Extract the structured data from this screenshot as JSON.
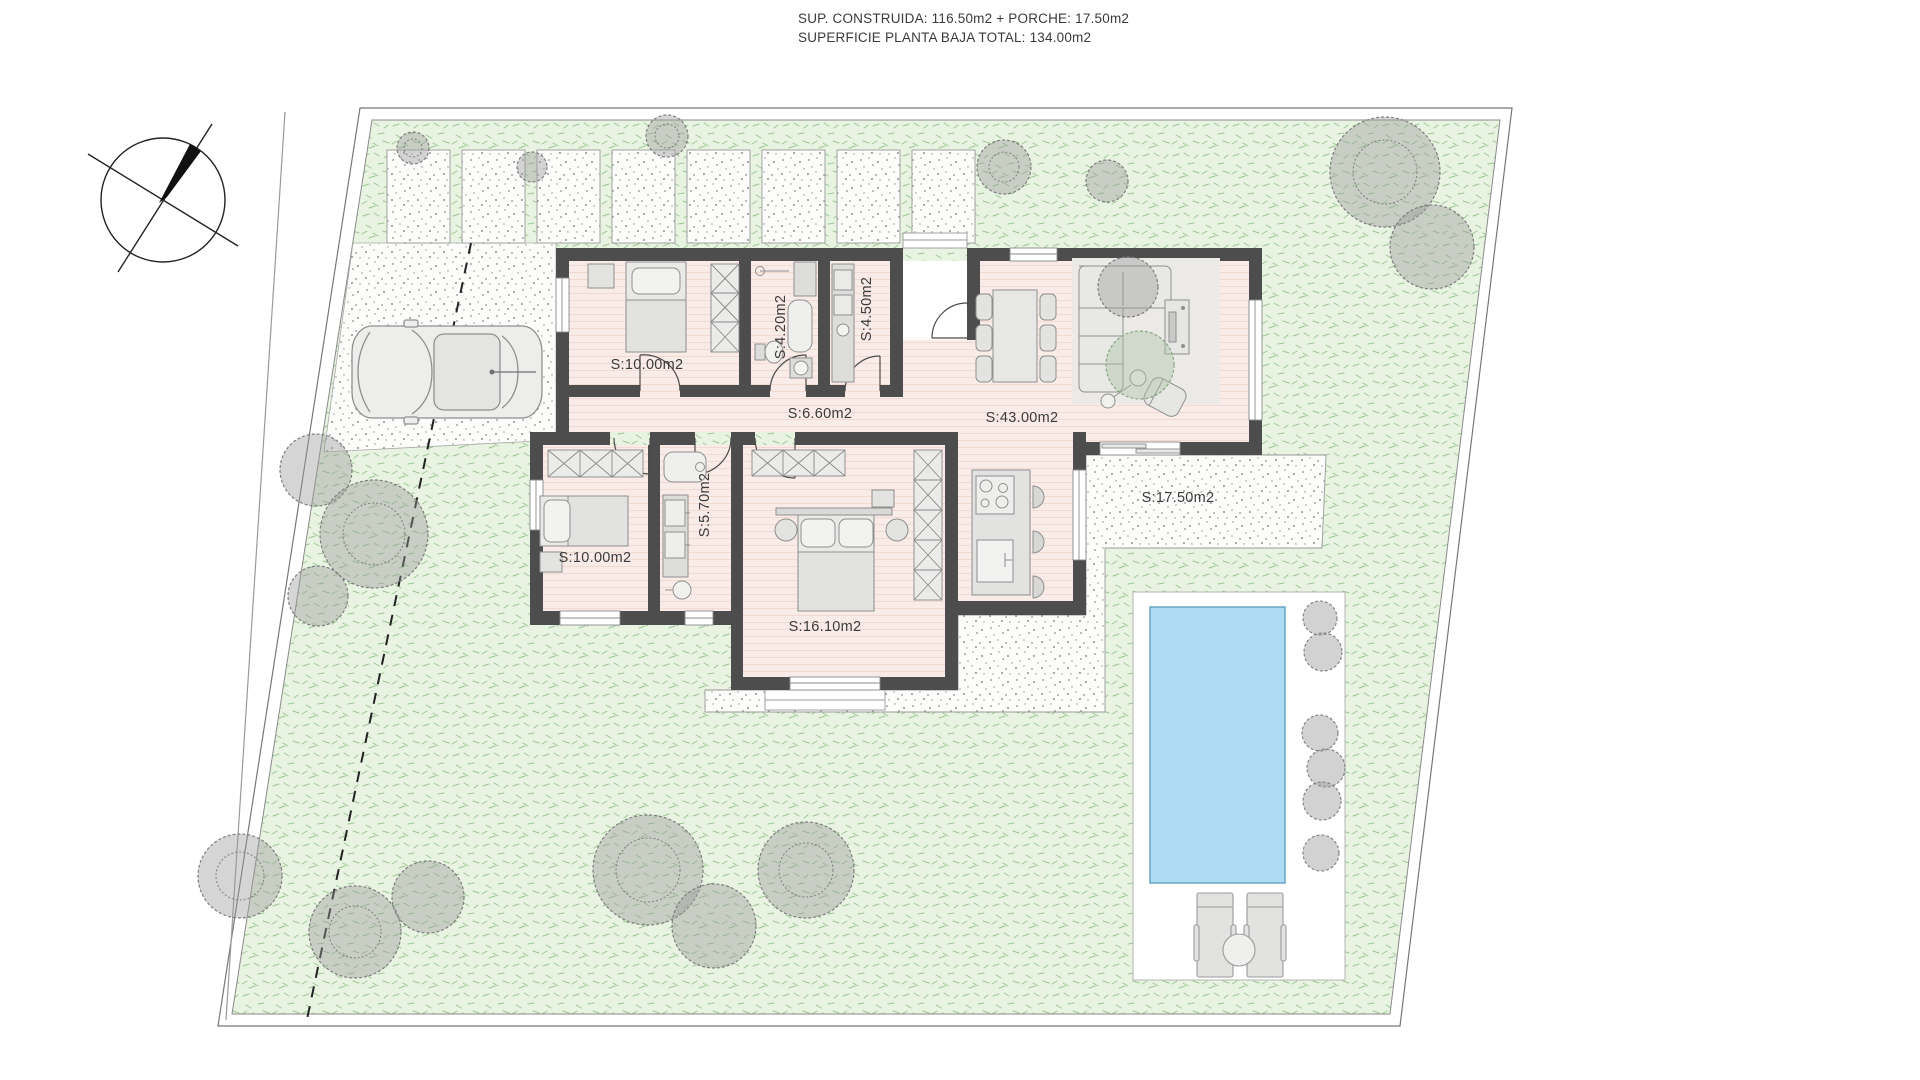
{
  "title": {
    "line1": "SUP. CONSTRUIDA: 116.50m2 + PORCHE: 17.50m2",
    "line2": "SUPERFICIE PLANTA BAJA TOTAL: 134.00m2"
  },
  "rooms": [
    {
      "name": "bedroom-1",
      "label": "S:10.00m2"
    },
    {
      "name": "bathroom-1",
      "label": "S:4.20m2"
    },
    {
      "name": "laundry",
      "label": "S:4.50m2"
    },
    {
      "name": "hallway",
      "label": "S:6.60m2"
    },
    {
      "name": "living-dining-kitchen",
      "label": "S:43.00m2"
    },
    {
      "name": "porch",
      "label": "S:17.50m2"
    },
    {
      "name": "bedroom-2",
      "label": "S:10.00m2"
    },
    {
      "name": "bathroom-2",
      "label": "S:5.70m2"
    },
    {
      "name": "master-bedroom",
      "label": "S:16.10m2"
    }
  ],
  "colors": {
    "lawn": "#e9f3e1",
    "grass_stroke": "#8cc084",
    "gravel": "#fcfcfb",
    "wall": "#4d4d4d",
    "floor": "#f9ebe7",
    "water": "#aedcf4",
    "tree": "#8f8f8f"
  }
}
